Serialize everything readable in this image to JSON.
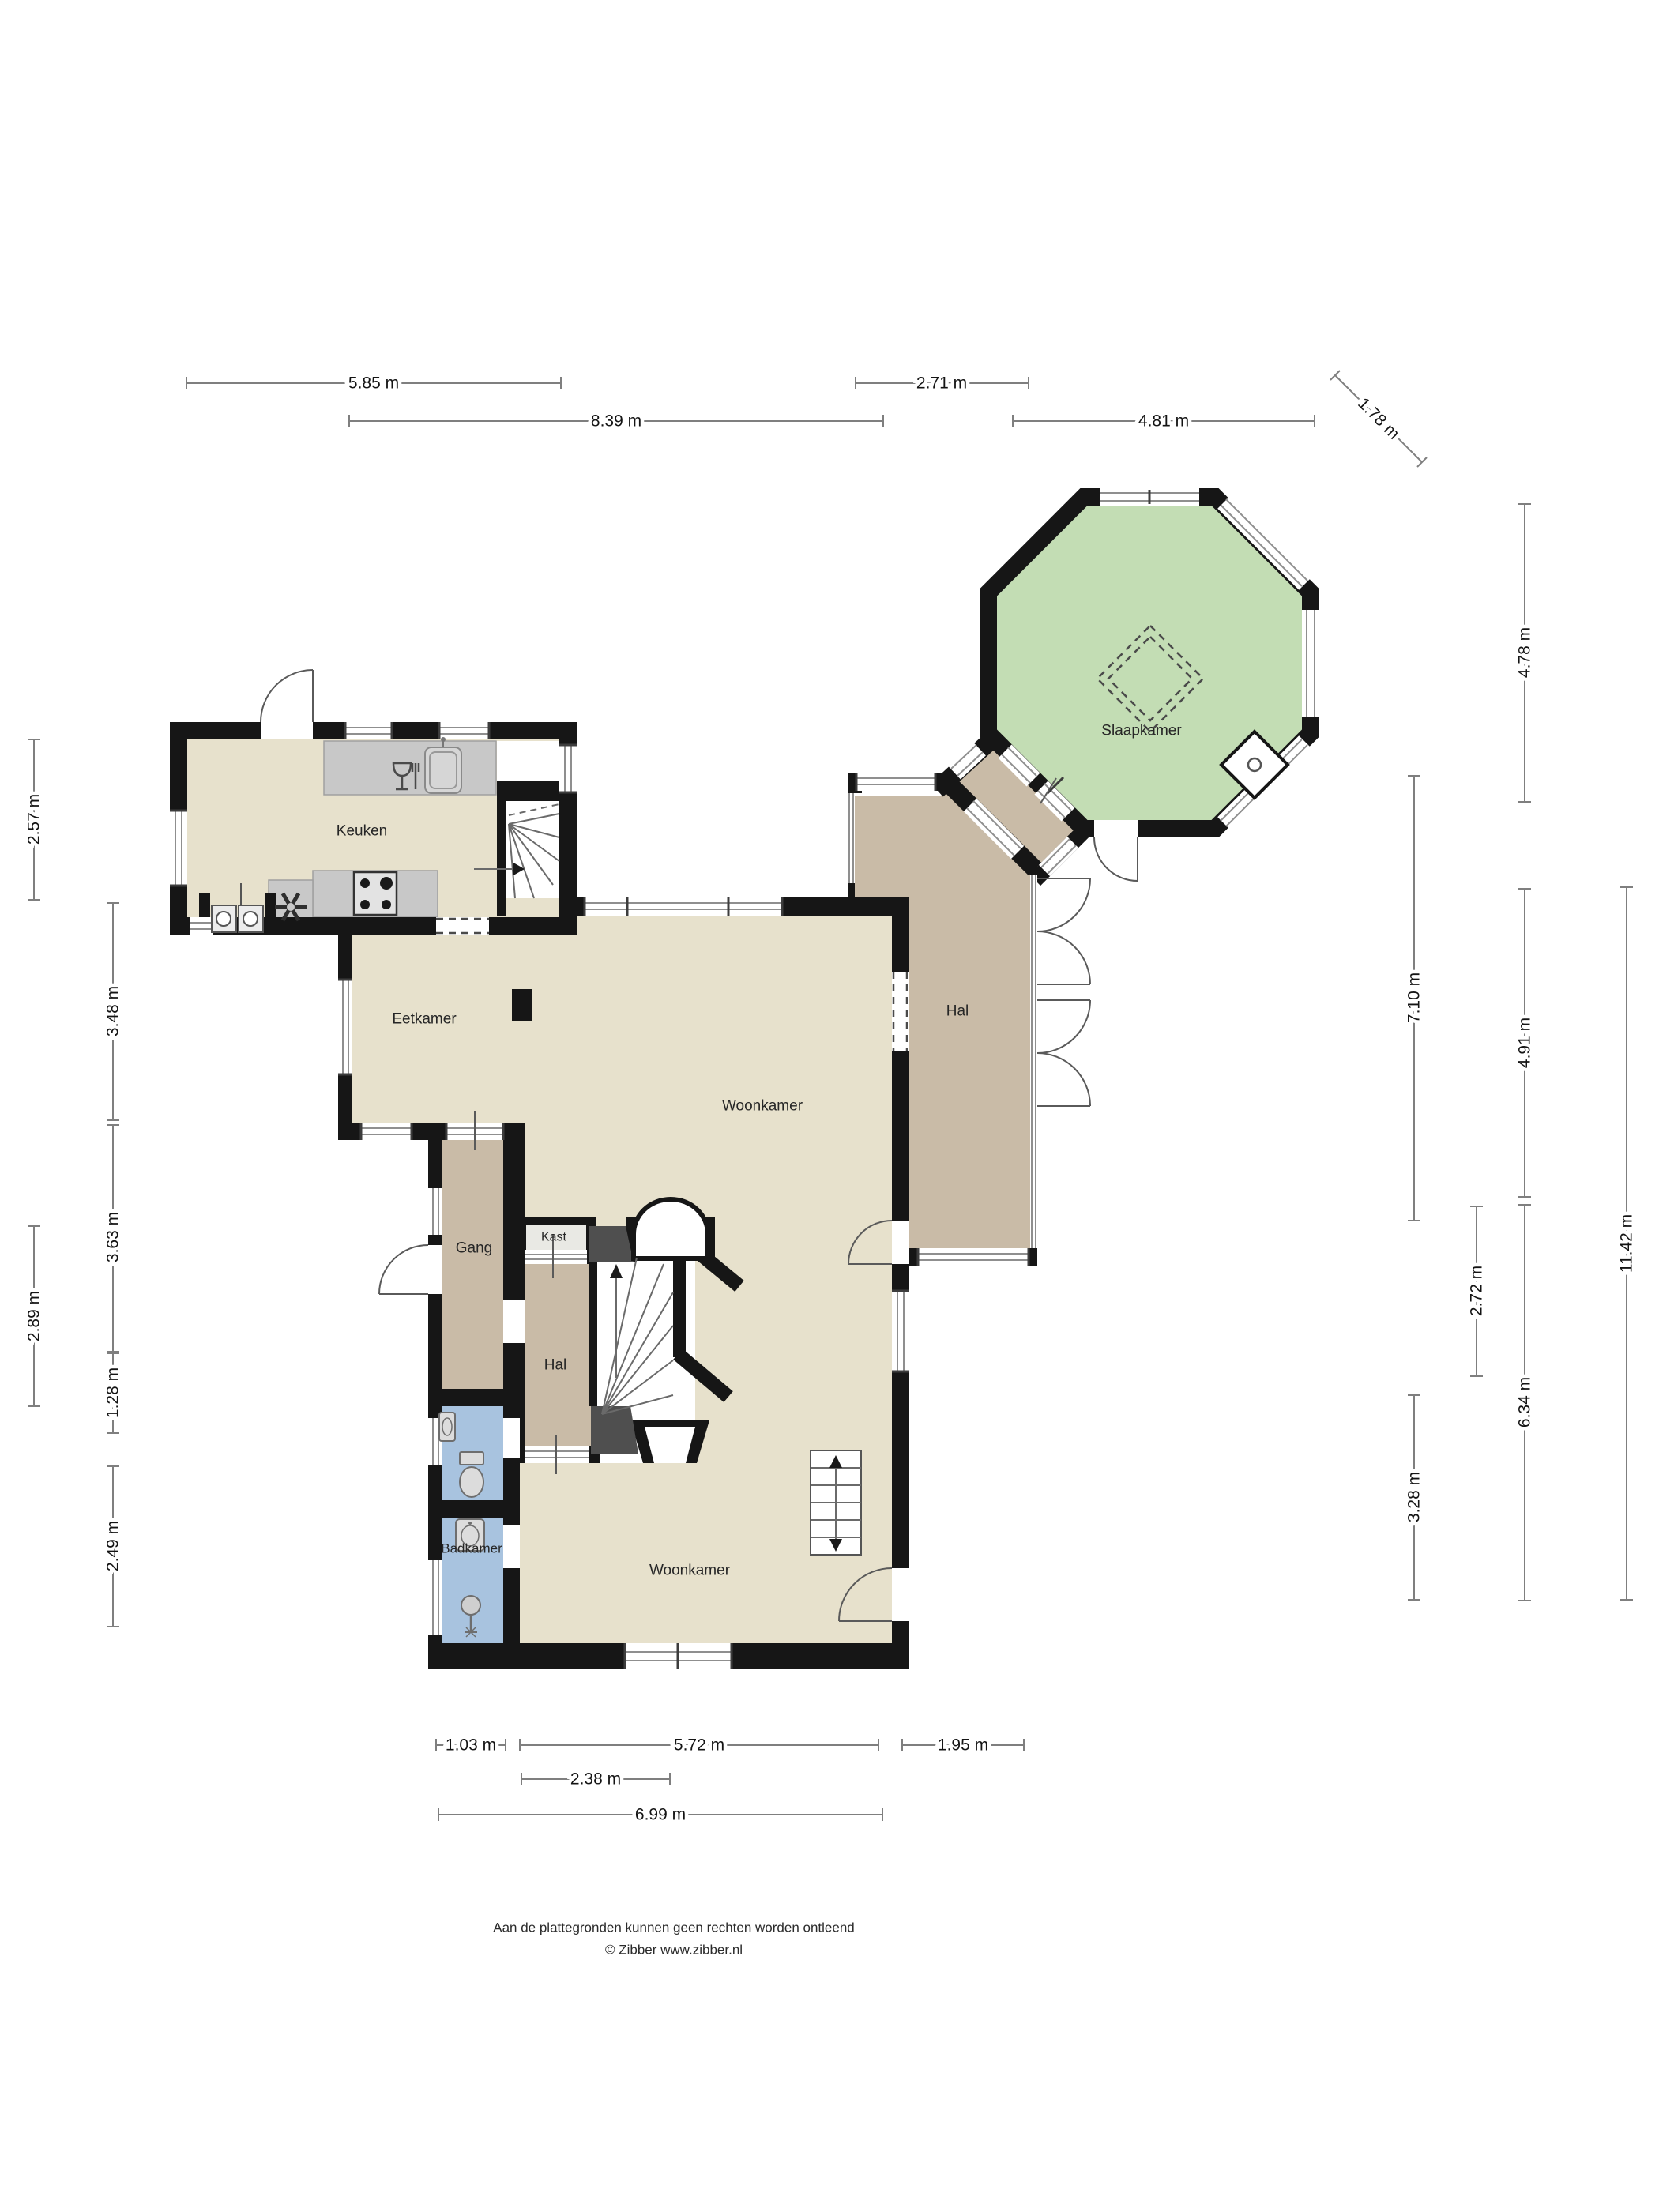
{
  "rooms": {
    "keuken": "Keuken",
    "eetkamer": "Eetkamer",
    "woonkamer_boven": "Woonkamer",
    "hal_boven": "Hal",
    "slaapkamer": "Slaapkamer",
    "gang": "Gang",
    "kast": "Kast",
    "hal_beneden": "Hal",
    "woonkamer_beneden": "Woonkamer",
    "badkamer": "Badkamer"
  },
  "dimensions": {
    "top": [
      "5.85 m",
      "2.71 m",
      "8.39 m",
      "4.81 m",
      "1.78 m"
    ],
    "right": [
      "4.78 m",
      "7.10 m",
      "4.91 m",
      "2.72 m",
      "6.34 m",
      "11.42 m",
      "3.28 m"
    ],
    "left": [
      "2.57 m",
      "3.48 m",
      "3.63 m",
      "2.89 m",
      "1.28 m",
      "2.49 m"
    ],
    "bottom": [
      "1.03 m",
      "5.72 m",
      "1.95 m",
      "2.38 m",
      "6.99 m"
    ]
  },
  "footer": {
    "line1": "Aan de plattegronden kunnen geen rechten worden ontleend",
    "line2": "© Zibber www.zibber.nl"
  },
  "colors": {
    "wall": "#161616",
    "beige": "#e7e1cc",
    "brown": "#c9bba7",
    "green": "#c3ddb4",
    "blue": "#a8c3df",
    "counter": "#c8c8c8",
    "chimney": "#4f4f4f",
    "kast": "#e9e9e4",
    "dim_line": "#7f7f7f"
  }
}
